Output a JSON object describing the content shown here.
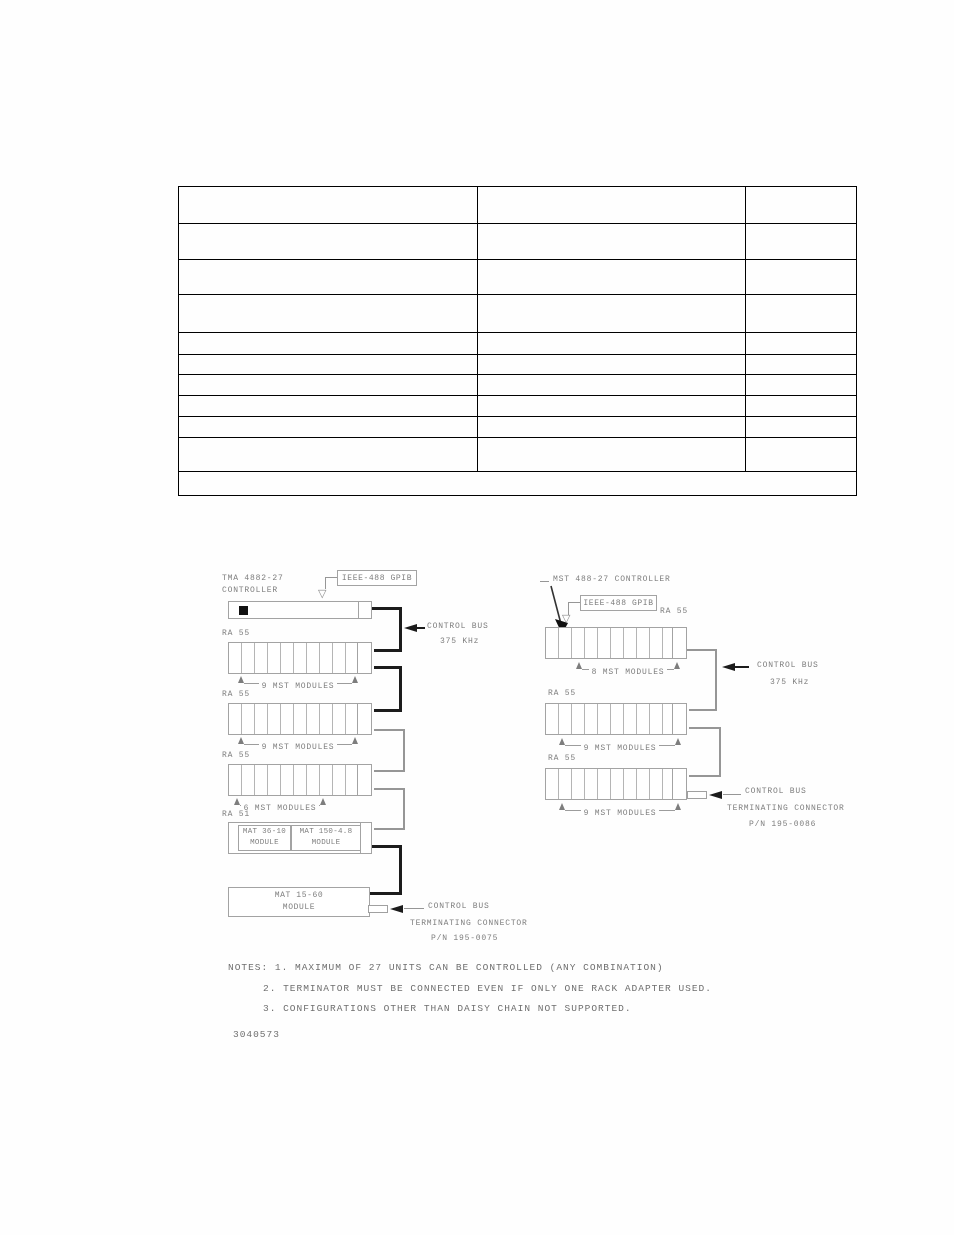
{
  "document": {
    "figure_number": "3040573",
    "table": {
      "columns": 3,
      "data_rows": 10,
      "footer_rows": 1
    },
    "glyphs": {
      "open_down_arrow": "▽"
    },
    "left_chain": {
      "controller_name": "TMA 4882-27",
      "controller_word": "CONTROLLER",
      "gpib_label": "IEEE-488 GPIB",
      "bus_label_1": "CONTROL BUS",
      "bus_label_2": "375 KHz",
      "racks": [
        {
          "name": "RA 55",
          "modules": "9 MST MODULES"
        },
        {
          "name": "RA 55",
          "modules": "9 MST MODULES"
        },
        {
          "name": "RA 55",
          "modules": "6 MST MODULES"
        },
        {
          "name": "RA 51"
        }
      ],
      "ra51_modules": [
        {
          "line1": "MAT 36-10",
          "line2": "MODULE"
        },
        {
          "line1": "MAT 150-4.8",
          "line2": "MODULE"
        }
      ],
      "standalone": {
        "line1": "MAT 15-60",
        "line2": "MODULE"
      },
      "terminator": {
        "line1": "CONTROL BUS",
        "line2": "TERMINATING CONNECTOR",
        "line3": "P/N 195-0075"
      }
    },
    "right_chain": {
      "controller_label": "MST 488-27 CONTROLLER",
      "gpib_label": "IEEE-488 GPIB",
      "bus_label_1": "CONTROL BUS",
      "bus_label_2": "375 KHz",
      "racks": [
        {
          "name": "RA 55",
          "modules": "8 MST MODULES"
        },
        {
          "name": "RA 55",
          "modules": "9 MST MODULES"
        },
        {
          "name": "RA 55",
          "modules": "9 MST MODULES"
        }
      ],
      "terminator": {
        "line1": "CONTROL BUS",
        "line2": "TERMINATING CONNECTOR",
        "line3": "P/N 195-0086"
      }
    },
    "notes": {
      "lines": [
        "NOTES: 1. MAXIMUM OF 27 UNITS CAN BE CONTROLLED (ANY COMBINATION)",
        "2. TERMINATOR MUST BE CONNECTED EVEN IF ONLY ONE RACK ADAPTER USED.",
        "3. CONFIGURATIONS OTHER THAN DAISY CHAIN NOT SUPPORTED."
      ]
    },
    "colors": {
      "line_gray": "#a3a3a3",
      "text_gray": "#7d7d7d",
      "bus_black": "#1c1c1c"
    }
  }
}
